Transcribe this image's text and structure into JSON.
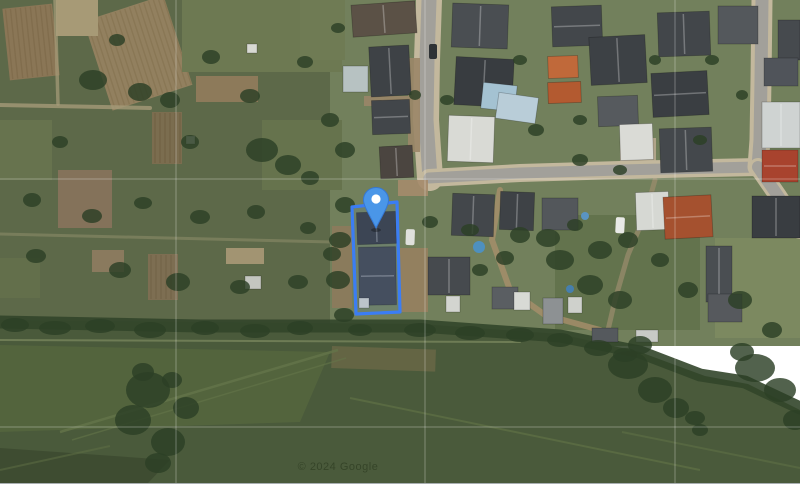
{
  "map": {
    "watermark": "© 2024 Google",
    "viewport": {
      "width": 800,
      "height": 483
    },
    "colors": {
      "allotment_base": "#5d6949",
      "residential_base": "#72805c",
      "meadow_base": "#4a5a3b",
      "hedge": "#32452a",
      "tree": "#2c3f26",
      "asphalt": "#a2a09a",
      "sidewalk": "#c3b89d",
      "parcel_stroke": "#3b7df4",
      "parcel_fill": "rgba(80,140,245,0.10)",
      "pin_fill": "#4a96e8",
      "pin_edge": "#3577d4",
      "pin_dot": "#ffffff",
      "graticule": "#ffffff",
      "watermark_color": "#223017",
      "bottom_bar": "#ffffff"
    },
    "zones": [
      {
        "n": "allotments-zone",
        "x": 0,
        "y": 0,
        "w": 346,
        "h": 346,
        "f": "#5d6949"
      },
      {
        "n": "residential-zone",
        "x": 330,
        "y": 0,
        "w": 470,
        "h": 346,
        "f": "#72805c"
      },
      {
        "n": "lawn-right-lower",
        "x": 715,
        "y": 238,
        "w": 85,
        "h": 100,
        "f": "#7d8a61",
        "o": 0.9
      },
      {
        "n": "garden-mid-lower",
        "x": 555,
        "y": 215,
        "w": 145,
        "h": 115,
        "f": "#5f6f4a",
        "o": 0.8
      }
    ],
    "meadow": {
      "points": "0,320 200,322 420,324 560,334 640,352 705,376 748,384 800,410 800,483 0,483",
      "fill": "#4a5a3b",
      "light_wedge": {
        "points": "0,345 330,352 300,422 0,432",
        "fill": "#57683f",
        "o": 0.7
      },
      "crop_rows": {
        "points": "0,448 170,460 148,483 0,483",
        "fill": "#3d4a31",
        "o": 0.9
      },
      "brown_streak": {
        "x": 332,
        "y": 346,
        "w": 104,
        "h": 22,
        "f": "#6e6a48",
        "o": 0.75,
        "rot": 2
      }
    },
    "hedge_line": {
      "pts": "0,322 200,326 420,326 560,336 640,352 700,375 745,382 800,408",
      "w": 13,
      "o": 0.9
    },
    "patches": [
      {
        "x": 6,
        "y": 6,
        "w": 50,
        "h": 72,
        "f": "#8a7656",
        "s": "#7c6848",
        "rot": -6
      },
      {
        "x": 96,
        "y": 6,
        "w": 84,
        "h": 94,
        "f": "#92805f",
        "s": "#84724f",
        "rot": -18
      },
      {
        "x": 56,
        "y": 0,
        "w": 42,
        "h": 36,
        "f": "#a79a76"
      },
      {
        "x": 182,
        "y": 0,
        "w": 160,
        "h": 72,
        "f": "#6d7952"
      },
      {
        "x": 196,
        "y": 76,
        "w": 62,
        "h": 26,
        "f": "#8d7a5a"
      },
      {
        "x": 152,
        "y": 112,
        "w": 30,
        "h": 52,
        "f": "#7b6d4f",
        "s": "#6d5f41",
        "rot": 0
      },
      {
        "x": 58,
        "y": 170,
        "w": 54,
        "h": 58,
        "f": "#84725a"
      },
      {
        "x": 0,
        "y": 120,
        "w": 52,
        "h": 60,
        "f": "#67734e"
      },
      {
        "x": 92,
        "y": 250,
        "w": 32,
        "h": 22,
        "f": "#8a7a5e"
      },
      {
        "x": 148,
        "y": 254,
        "w": 30,
        "h": 46,
        "f": "#7d6e52",
        "s": "#6f6046",
        "rot": 0
      },
      {
        "x": 226,
        "y": 248,
        "w": 38,
        "h": 16,
        "f": "#a29472"
      },
      {
        "x": 262,
        "y": 120,
        "w": 80,
        "h": 70,
        "f": "#66734d"
      },
      {
        "x": 0,
        "y": 258,
        "w": 40,
        "h": 40,
        "f": "#636f4b"
      },
      {
        "x": 300,
        "y": 0,
        "w": 45,
        "h": 60,
        "f": "#6f7b54"
      },
      {
        "x": 620,
        "y": 138,
        "w": 36,
        "h": 24,
        "f": "#b0a489"
      }
    ],
    "lanes": [
      {
        "pts": "0,105 150,108",
        "w": 4,
        "c": "#a59a78",
        "o": 0.8
      },
      {
        "pts": "55,0 58,104",
        "w": 3.5,
        "c": "#a89c7a",
        "o": 0.7
      },
      {
        "pts": "0,234 332,242",
        "w": 3,
        "c": "#8b8a68",
        "o": 0.6
      },
      {
        "pts": "500,190 492,240 510,290 545,315 600,330",
        "w": 6,
        "c": "#a78f6b",
        "o": 0.8
      },
      {
        "pts": "655,180 645,215 628,255 615,300 608,330",
        "w": 5,
        "c": "#9d8d6d",
        "o": 0.7
      },
      {
        "pts": "0,340 520,342",
        "w": 2,
        "c": "#77855c",
        "o": 0.8
      }
    ],
    "tracks": [
      {
        "pts": "60,432 338,350",
        "w": 2.5,
        "c": "#64744a",
        "o": 0.8
      },
      {
        "pts": "72,440 346,358",
        "w": 1.5,
        "c": "#64744a",
        "o": 0.6
      },
      {
        "pts": "350,398 700,470",
        "w": 2,
        "c": "#5f7046",
        "o": 0.7
      },
      {
        "pts": "622,432 800,468",
        "w": 2,
        "c": "#5f7046",
        "o": 0.6
      },
      {
        "pts": "0,470 110,446",
        "w": 2,
        "c": "#5f7046",
        "o": 0.5
      }
    ],
    "streets": [
      {
        "n": "street-vertical-main",
        "pts": "429,0 427,60 426,120 430,178",
        "aw": 15,
        "sw": 26
      },
      {
        "n": "street-horizontal",
        "pts": "429,178 520,173 620,170 758,167",
        "aw": 11,
        "sw": 18
      },
      {
        "n": "street-right-vertical",
        "pts": "762,0 761,80 760,140 758,167",
        "aw": 13,
        "sw": 21
      },
      {
        "n": "street-right-diagonal",
        "pts": "758,167 778,196 800,230",
        "aw": 12,
        "sw": 18
      }
    ],
    "dirt": [
      {
        "x": 408,
        "y": 58,
        "w": 12,
        "h": 94,
        "f": "#9b8668"
      },
      {
        "x": 398,
        "y": 180,
        "w": 30,
        "h": 16,
        "f": "#a58b6b"
      },
      {
        "x": 400,
        "y": 248,
        "w": 28,
        "h": 64,
        "f": "#97805f"
      },
      {
        "x": 332,
        "y": 226,
        "w": 20,
        "h": 82,
        "f": "#8d7a5c"
      },
      {
        "x": 364,
        "y": 96,
        "w": 44,
        "h": 10,
        "f": "#9a8568"
      }
    ],
    "houses": [
      {
        "x": 352,
        "y": 3,
        "w": 64,
        "h": 32,
        "r": -4,
        "f": "#5b5146",
        "g": "v"
      },
      {
        "x": 343,
        "y": 66,
        "w": 25,
        "h": 26,
        "r": 0,
        "f": "#b7c2c2",
        "g": ""
      },
      {
        "x": 370,
        "y": 46,
        "w": 40,
        "h": 50,
        "r": -3,
        "f": "#3e4246",
        "g": "v"
      },
      {
        "x": 372,
        "y": 100,
        "w": 38,
        "h": 34,
        "r": -2,
        "f": "#42464a",
        "g": "h"
      },
      {
        "x": 380,
        "y": 146,
        "w": 33,
        "h": 32,
        "r": -3,
        "f": "#4b4540",
        "g": "v"
      },
      {
        "x": 452,
        "y": 4,
        "w": 56,
        "h": 44,
        "r": 2,
        "f": "#4a4e52",
        "g": "v"
      },
      {
        "x": 455,
        "y": 58,
        "w": 58,
        "h": 48,
        "r": 3,
        "f": "#383c40",
        "g": "v"
      },
      {
        "x": 482,
        "y": 84,
        "w": 34,
        "h": 26,
        "r": 6,
        "f": "#a4c2d2",
        "g": ""
      },
      {
        "x": 497,
        "y": 95,
        "w": 40,
        "h": 26,
        "r": 8,
        "f": "#b9cdd8",
        "g": ""
      },
      {
        "x": 448,
        "y": 116,
        "w": 46,
        "h": 46,
        "r": 2,
        "f": "#d9dad5",
        "g": "v"
      },
      {
        "x": 548,
        "y": 56,
        "w": 30,
        "h": 22,
        "r": -2,
        "f": "#c0693a",
        "g": ""
      },
      {
        "x": 548,
        "y": 82,
        "w": 33,
        "h": 21,
        "r": -2,
        "f": "#b35a30",
        "g": ""
      },
      {
        "x": 552,
        "y": 6,
        "w": 50,
        "h": 40,
        "r": -2,
        "f": "#43474b",
        "g": "h"
      },
      {
        "x": 590,
        "y": 36,
        "w": 56,
        "h": 48,
        "r": -3,
        "f": "#3d4145",
        "g": "v"
      },
      {
        "x": 598,
        "y": 96,
        "w": 40,
        "h": 30,
        "r": -2,
        "f": "#565a5e",
        "g": ""
      },
      {
        "x": 620,
        "y": 124,
        "w": 33,
        "h": 36,
        "r": -2,
        "f": "#dadbd6",
        "g": ""
      },
      {
        "x": 658,
        "y": 12,
        "w": 52,
        "h": 44,
        "r": -2,
        "f": "#42464a",
        "g": "v"
      },
      {
        "x": 652,
        "y": 72,
        "w": 56,
        "h": 44,
        "r": -3,
        "f": "#3a3e42",
        "g": "h"
      },
      {
        "x": 660,
        "y": 128,
        "w": 52,
        "h": 44,
        "r": -2,
        "f": "#44484c",
        "g": "v"
      },
      {
        "x": 718,
        "y": 6,
        "w": 40,
        "h": 38,
        "r": 0,
        "f": "#54585c",
        "g": ""
      },
      {
        "x": 778,
        "y": 20,
        "w": 22,
        "h": 40,
        "r": 0,
        "f": "#464a4e",
        "g": ""
      },
      {
        "x": 764,
        "y": 58,
        "w": 34,
        "h": 28,
        "r": 0,
        "f": "#50545a",
        "g": ""
      },
      {
        "x": 762,
        "y": 102,
        "w": 38,
        "h": 46,
        "r": 0,
        "f": "#cfd3d2",
        "g": "v"
      },
      {
        "x": 762,
        "y": 150,
        "w": 36,
        "h": 32,
        "r": 0,
        "f": "#a8432e",
        "g": "h"
      },
      {
        "x": 452,
        "y": 194,
        "w": 42,
        "h": 42,
        "r": 2,
        "f": "#43474b",
        "g": "v"
      },
      {
        "x": 500,
        "y": 192,
        "w": 34,
        "h": 38,
        "r": 2,
        "f": "#3e4246",
        "g": "v"
      },
      {
        "x": 542,
        "y": 198,
        "w": 36,
        "h": 32,
        "r": 0,
        "f": "#53575b",
        "g": ""
      },
      {
        "x": 636,
        "y": 192,
        "w": 33,
        "h": 38,
        "r": -2,
        "f": "#d6d8d3",
        "g": "v"
      },
      {
        "x": 664,
        "y": 196,
        "w": 48,
        "h": 42,
        "r": -3,
        "f": "#a5512f",
        "g": "h"
      },
      {
        "x": 706,
        "y": 246,
        "w": 26,
        "h": 56,
        "r": 0,
        "f": "#4a4e52",
        "g": "v"
      },
      {
        "x": 708,
        "y": 294,
        "w": 34,
        "h": 28,
        "r": 0,
        "f": "#56595d",
        "g": ""
      },
      {
        "x": 752,
        "y": 196,
        "w": 48,
        "h": 42,
        "r": 0,
        "f": "#393d41",
        "g": "v"
      }
    ],
    "parcel_buildings": [
      {
        "x": 357,
        "y": 212,
        "w": 39,
        "h": 32,
        "r": -2,
        "f": "#3a3e42",
        "g": "v"
      },
      {
        "x": 359,
        "y": 247,
        "w": 37,
        "h": 58,
        "r": -1,
        "f": "#45494e",
        "g": "h"
      },
      {
        "x": 359,
        "y": 298,
        "w": 10,
        "h": 10,
        "r": 0,
        "f": "#c9cbc7",
        "g": ""
      }
    ],
    "sheds": [
      {
        "x": 428,
        "y": 257,
        "w": 42,
        "h": 38,
        "r": 0,
        "f": "#464a4e",
        "g": "v"
      },
      {
        "x": 446,
        "y": 296,
        "w": 14,
        "h": 16,
        "r": 0,
        "f": "#d3d5d0",
        "g": ""
      },
      {
        "x": 492,
        "y": 287,
        "w": 26,
        "h": 22,
        "r": 0,
        "f": "#5a5e62",
        "g": ""
      },
      {
        "x": 514,
        "y": 292,
        "w": 16,
        "h": 18,
        "r": 0,
        "f": "#d8dad5",
        "g": ""
      },
      {
        "x": 543,
        "y": 298,
        "w": 20,
        "h": 26,
        "r": 0,
        "f": "#8d9193",
        "g": ""
      },
      {
        "x": 568,
        "y": 297,
        "w": 14,
        "h": 16,
        "r": 0,
        "f": "#cfd1cc",
        "g": ""
      },
      {
        "x": 592,
        "y": 328,
        "w": 26,
        "h": 14,
        "r": 0,
        "f": "#55595d",
        "g": ""
      },
      {
        "x": 636,
        "y": 330,
        "w": 22,
        "h": 12,
        "r": 0,
        "f": "#c8cac6",
        "g": ""
      },
      {
        "x": 247,
        "y": 44,
        "w": 10,
        "h": 9,
        "r": 0,
        "f": "#d8d9d3",
        "g": ""
      },
      {
        "x": 186,
        "y": 136,
        "w": 9,
        "h": 8,
        "r": 0,
        "f": "#cfd0ca",
        "g": ""
      },
      {
        "x": 245,
        "y": 276,
        "w": 16,
        "h": 13,
        "r": 0,
        "f": "#c4c6c0",
        "g": ""
      }
    ],
    "cars": [
      {
        "x": 429,
        "y": 44,
        "w": 8,
        "h": 15,
        "r": 0,
        "f": "#2e3235"
      },
      {
        "x": 616,
        "y": 217,
        "w": 9,
        "h": 16,
        "r": 3,
        "f": "#e8e9e6"
      },
      {
        "x": 406,
        "y": 229,
        "w": 9,
        "h": 16,
        "r": 2,
        "f": "#dfe0dc"
      }
    ],
    "pools": [
      {
        "cx": 479,
        "cy": 247,
        "r": 6,
        "f": "#4e90bf"
      },
      {
        "cx": 570,
        "cy": 289,
        "r": 4,
        "f": "#467fae"
      },
      {
        "cx": 585,
        "cy": 216,
        "r": 4,
        "f": "#5a94c2"
      }
    ],
    "trees": [
      [
        93,
        80,
        14,
        10
      ],
      [
        140,
        92,
        12,
        9
      ],
      [
        170,
        100,
        10,
        8
      ],
      [
        117,
        40,
        8,
        6
      ],
      [
        211,
        57,
        9,
        7
      ],
      [
        250,
        96,
        10,
        7
      ],
      [
        305,
        62,
        8,
        6
      ],
      [
        190,
        142,
        9,
        7
      ],
      [
        262,
        150,
        16,
        12
      ],
      [
        288,
        165,
        13,
        10
      ],
      [
        310,
        178,
        9,
        7
      ],
      [
        60,
        142,
        8,
        6
      ],
      [
        32,
        200,
        9,
        7
      ],
      [
        92,
        216,
        10,
        7
      ],
      [
        143,
        203,
        9,
        6
      ],
      [
        200,
        217,
        10,
        7
      ],
      [
        256,
        212,
        9,
        7
      ],
      [
        308,
        228,
        8,
        6
      ],
      [
        36,
        256,
        10,
        7
      ],
      [
        120,
        270,
        11,
        8
      ],
      [
        178,
        282,
        12,
        9
      ],
      [
        240,
        287,
        10,
        7
      ],
      [
        298,
        282,
        10,
        7
      ],
      [
        332,
        254,
        9,
        7
      ],
      [
        345,
        150,
        10,
        8
      ],
      [
        330,
        120,
        9,
        7
      ],
      [
        338,
        28,
        7,
        5
      ],
      [
        415,
        95,
        6,
        5
      ],
      [
        447,
        100,
        7,
        5
      ],
      [
        520,
        60,
        7,
        5
      ],
      [
        536,
        130,
        8,
        6
      ],
      [
        580,
        120,
        7,
        5
      ],
      [
        655,
        60,
        6,
        5
      ],
      [
        712,
        60,
        7,
        5
      ],
      [
        742,
        95,
        6,
        5
      ],
      [
        700,
        140,
        7,
        5
      ],
      [
        580,
        160,
        8,
        6
      ],
      [
        620,
        170,
        7,
        5
      ],
      [
        345,
        205,
        10,
        8
      ],
      [
        340,
        240,
        11,
        8
      ],
      [
        338,
        280,
        12,
        9
      ],
      [
        344,
        315,
        10,
        7
      ],
      [
        430,
        222,
        8,
        6
      ],
      [
        470,
        230,
        9,
        6
      ],
      [
        520,
        235,
        10,
        8
      ],
      [
        548,
        238,
        12,
        9
      ],
      [
        560,
        260,
        14,
        10
      ],
      [
        600,
        250,
        12,
        9
      ],
      [
        628,
        240,
        10,
        8
      ],
      [
        590,
        285,
        13,
        10
      ],
      [
        620,
        300,
        12,
        9
      ],
      [
        660,
        260,
        9,
        7
      ],
      [
        688,
        290,
        10,
        8
      ],
      [
        740,
        300,
        12,
        9
      ],
      [
        772,
        330,
        10,
        8
      ],
      [
        575,
        225,
        8,
        6
      ],
      [
        505,
        258,
        9,
        7
      ],
      [
        480,
        270,
        8,
        6
      ],
      [
        148,
        390,
        22,
        18
      ],
      [
        133,
        420,
        18,
        15
      ],
      [
        168,
        442,
        17,
        14
      ],
      [
        186,
        408,
        13,
        11
      ],
      [
        158,
        463,
        13,
        10
      ],
      [
        143,
        372,
        11,
        9
      ],
      [
        172,
        380,
        10,
        8
      ],
      [
        628,
        365,
        20,
        14
      ],
      [
        655,
        390,
        17,
        13
      ],
      [
        676,
        408,
        13,
        10
      ],
      [
        640,
        345,
        12,
        9
      ],
      [
        755,
        368,
        20,
        14
      ],
      [
        780,
        390,
        16,
        12
      ],
      [
        742,
        352,
        12,
        9
      ],
      [
        795,
        420,
        12,
        10
      ],
      [
        700,
        430,
        8,
        6
      ],
      [
        695,
        418,
        10,
        7
      ],
      [
        15,
        325,
        14,
        7
      ],
      [
        55,
        328,
        16,
        7
      ],
      [
        100,
        326,
        15,
        7
      ],
      [
        150,
        330,
        16,
        8
      ],
      [
        205,
        328,
        14,
        7
      ],
      [
        255,
        331,
        15,
        7
      ],
      [
        300,
        328,
        13,
        7
      ],
      [
        360,
        330,
        12,
        6
      ],
      [
        420,
        330,
        16,
        7
      ],
      [
        470,
        333,
        15,
        7
      ],
      [
        520,
        335,
        14,
        7
      ],
      [
        560,
        340,
        13,
        7
      ],
      [
        598,
        348,
        14,
        8
      ],
      [
        625,
        355,
        12,
        7
      ]
    ],
    "graticule": {
      "vertical_x": [
        176,
        425,
        675
      ],
      "horizontal_y": [
        179,
        427
      ],
      "opacity": 0.3
    },
    "parcel": {
      "points": "352,207 397,202 400,312 356,314",
      "stroke_width": 3.2
    },
    "pin": {
      "tip_x": 376,
      "tip_y": 228,
      "head_cx": 376,
      "head_cy": 200,
      "head_r": 12.5,
      "dot_r": 4.6
    },
    "watermark_pos": {
      "x": 338,
      "y": 470,
      "size": 11
    }
  }
}
